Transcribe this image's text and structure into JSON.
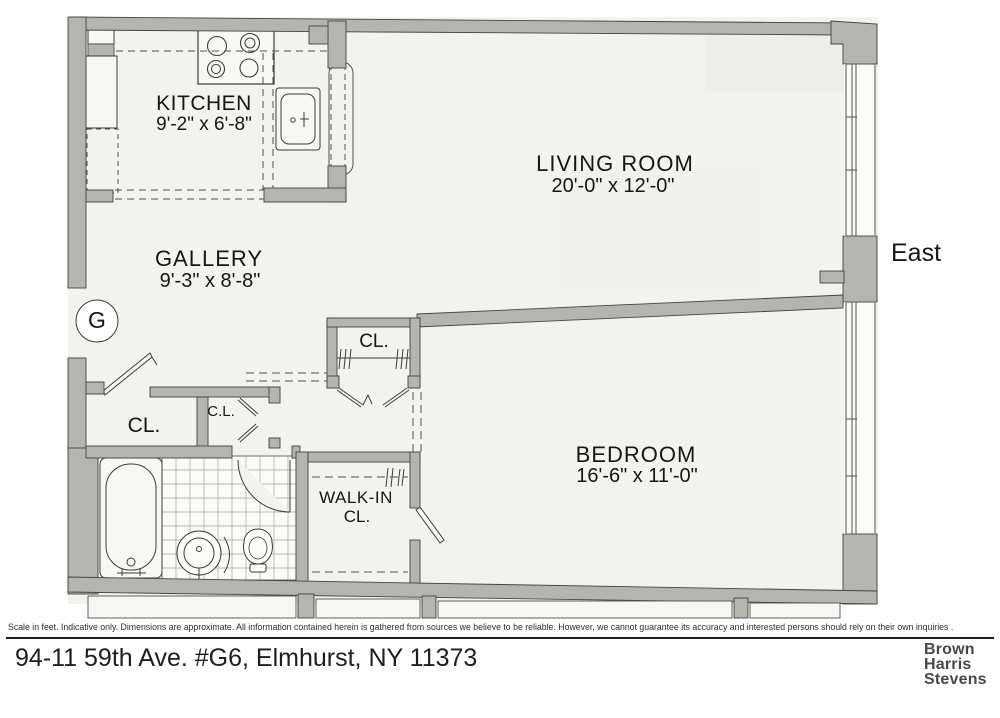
{
  "plan": {
    "unit_marker": "G",
    "orientation_label": "East"
  },
  "rooms": {
    "kitchen": {
      "name": "KITCHEN",
      "dims": "9'-2\" x 6'-8\""
    },
    "living_room": {
      "name": "LIVING ROOM",
      "dims": "20'-0\" x 12'-0\""
    },
    "gallery": {
      "name": "GALLERY",
      "dims": "9'-3\" x 8'-8\""
    },
    "bedroom": {
      "name": "BEDROOM",
      "dims": "16'-6\" x 11'-0\""
    },
    "closet_entry": {
      "label": "CL."
    },
    "closet_hall": {
      "label": "C.L."
    },
    "closet_bedroom": {
      "label": "CL."
    },
    "walk_in_closet": {
      "line1": "WALK-IN",
      "line2": "CL."
    }
  },
  "footer": {
    "disclaimer": "Scale in feet. Indicative only. Dimensions are approximate. All information contained herein is gathered from sources we believe to be reliable. However, we cannot guarantee its accuracy and interested persons should rely on their own inquiries .",
    "address": "94-11 59th Ave. #G6, Elmhurst, NY 11373",
    "brokerage": {
      "line1": "Brown",
      "line2": "Harris",
      "line3": "Stevens"
    }
  },
  "colors": {
    "wall": "#b5b5af",
    "wall_outline": "#45453f",
    "floor": "#f2f2ee",
    "line": "#3c3c38",
    "logo_text": "#474747"
  }
}
